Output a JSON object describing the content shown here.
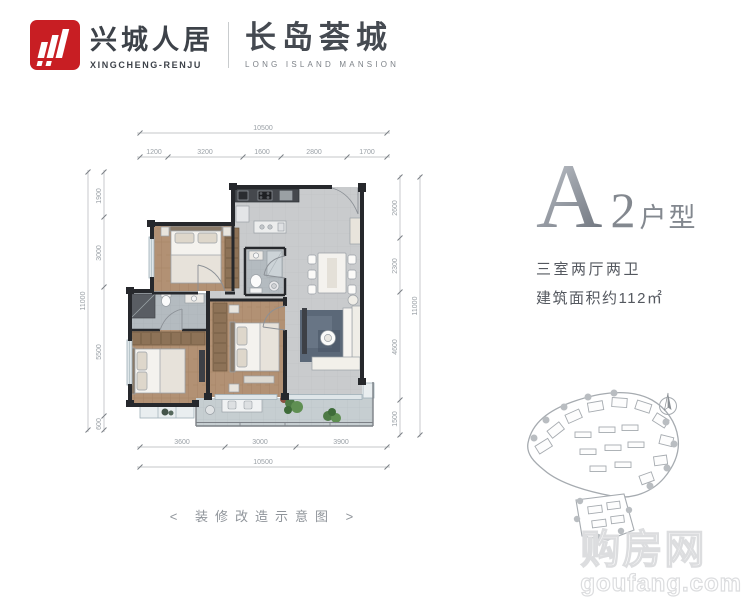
{
  "header": {
    "brand_zh": "兴城人居",
    "brand_en": "XINGCHENG-RENJU",
    "project_zh": "长岛荟城",
    "project_en": "LONG ISLAND MANSION"
  },
  "unit": {
    "letter": "A",
    "number": "2",
    "type_suffix": "户型",
    "rooms": "三室两厅两卫",
    "area": "建筑面积约112㎡"
  },
  "caption": "< 装修改造示意图 >",
  "watermark": {
    "zh": "购房网",
    "en": "goufang.com"
  },
  "dimensions": {
    "top_overall": "10500",
    "top_segments": [
      "1200",
      "3200",
      "1600",
      "2800",
      "1700"
    ],
    "bottom_segments": [
      "3600",
      "3000",
      "3900"
    ],
    "bottom_overall": "10500",
    "left_overall": "11000",
    "left_segments": [
      "1900",
      "3000",
      "5500",
      "600"
    ],
    "right_segments": [
      "2600",
      "2300",
      "4600",
      "1500"
    ],
    "right_overall": "11000"
  },
  "colors": {
    "brand_red": "#c81e23",
    "wall": "#26282c",
    "wood_floor": "#b29174",
    "tile_floor": "#c9cbcd",
    "balcony_floor": "#c6ced1",
    "bath_floor": "#b4bbc0",
    "rug": "#5b6878",
    "wardrobe": "#8d7257",
    "dim_line": "#b0b4b8",
    "unit_text_gray": "#83888f"
  }
}
